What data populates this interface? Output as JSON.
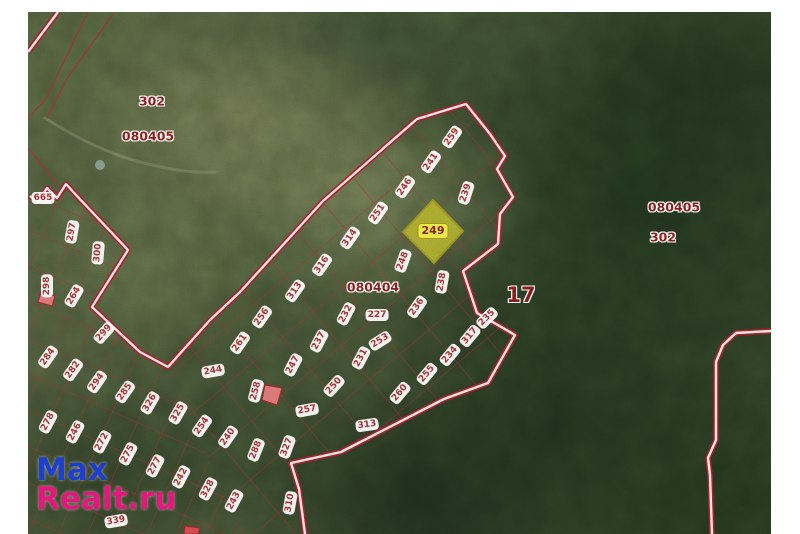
{
  "page": {
    "background": "#ffffff"
  },
  "map": {
    "type": "satellite-cadastral-map",
    "highlight_parcel": {
      "number": "249",
      "fill": "#d6d632",
      "border": "#b0a428"
    },
    "colors": {
      "boundary_red": "#c22330",
      "boundary_core": "#ffffff",
      "grid_red": "#c03434",
      "pill_background": "#ffffff",
      "pill_text": "#a83434",
      "quarter_text": "#8b1d1d",
      "pink_parcel_fill": "#f08888"
    },
    "watermark": {
      "line1": "Max",
      "line2": "Realt.ru",
      "color1": "#1e3fcb",
      "color2": "#e4187c"
    },
    "labels": [
      {
        "t": "302",
        "x": 152,
        "y": 101,
        "r": 0,
        "cls": "q"
      },
      {
        "t": "080405",
        "x": 148,
        "y": 136,
        "r": 0,
        "cls": "q"
      },
      {
        "t": "080405",
        "x": 674,
        "y": 207,
        "r": 0,
        "cls": "q"
      },
      {
        "t": "302",
        "x": 663,
        "y": 237,
        "r": 0,
        "cls": "q"
      },
      {
        "t": "080404",
        "x": 373,
        "y": 287,
        "r": 0,
        "cls": "q"
      },
      {
        "t": "17",
        "x": 521,
        "y": 295,
        "r": 0,
        "cls": "q17"
      },
      {
        "t": "249",
        "x": 433,
        "y": 231,
        "r": 0,
        "cls": "hl"
      },
      {
        "t": "259",
        "x": 452,
        "y": 137,
        "r": -55,
        "cls": "p"
      },
      {
        "t": "241",
        "x": 431,
        "y": 162,
        "r": -55,
        "cls": "p"
      },
      {
        "t": "246",
        "x": 405,
        "y": 187,
        "r": -55,
        "cls": "p"
      },
      {
        "t": "239",
        "x": 466,
        "y": 193,
        "r": -72,
        "cls": "p"
      },
      {
        "t": "251",
        "x": 378,
        "y": 213,
        "r": -55,
        "cls": "p"
      },
      {
        "t": "314",
        "x": 350,
        "y": 238,
        "r": -55,
        "cls": "p"
      },
      {
        "t": "316",
        "x": 322,
        "y": 265,
        "r": -55,
        "cls": "p"
      },
      {
        "t": "313",
        "x": 295,
        "y": 291,
        "r": -55,
        "cls": "p"
      },
      {
        "t": "256",
        "x": 262,
        "y": 317,
        "r": -55,
        "cls": "p"
      },
      {
        "t": "261",
        "x": 240,
        "y": 343,
        "r": -55,
        "cls": "p"
      },
      {
        "t": "248",
        "x": 403,
        "y": 261,
        "r": -70,
        "cls": "p"
      },
      {
        "t": "238",
        "x": 442,
        "y": 282,
        "r": -80,
        "cls": "p"
      },
      {
        "t": "236",
        "x": 417,
        "y": 307,
        "r": -55,
        "cls": "p"
      },
      {
        "t": "227",
        "x": 377,
        "y": 315,
        "r": 0,
        "cls": "p"
      },
      {
        "t": "232",
        "x": 346,
        "y": 314,
        "r": -62,
        "cls": "p"
      },
      {
        "t": "237",
        "x": 319,
        "y": 341,
        "r": -62,
        "cls": "p"
      },
      {
        "t": "253",
        "x": 380,
        "y": 341,
        "r": -32,
        "cls": "p"
      },
      {
        "t": "231",
        "x": 361,
        "y": 358,
        "r": -62,
        "cls": "p"
      },
      {
        "t": "247",
        "x": 293,
        "y": 365,
        "r": -62,
        "cls": "p"
      },
      {
        "t": "250",
        "x": 334,
        "y": 386,
        "r": -48,
        "cls": "p"
      },
      {
        "t": "260",
        "x": 400,
        "y": 393,
        "r": -50,
        "cls": "p"
      },
      {
        "t": "235",
        "x": 487,
        "y": 318,
        "r": -45,
        "cls": "p"
      },
      {
        "t": "317",
        "x": 470,
        "y": 336,
        "r": -50,
        "cls": "p"
      },
      {
        "t": "234",
        "x": 450,
        "y": 355,
        "r": -50,
        "cls": "p"
      },
      {
        "t": "255",
        "x": 427,
        "y": 374,
        "r": -50,
        "cls": "p"
      },
      {
        "t": "244",
        "x": 213,
        "y": 371,
        "r": -10,
        "cls": "p"
      },
      {
        "t": "258",
        "x": 256,
        "y": 391,
        "r": -75,
        "cls": "p"
      },
      {
        "t": "257",
        "x": 307,
        "y": 410,
        "r": -10,
        "cls": "p"
      },
      {
        "t": "313",
        "x": 367,
        "y": 425,
        "r": -8,
        "cls": "p"
      },
      {
        "t": "665",
        "x": 43,
        "y": 198,
        "r": 0,
        "cls": "p"
      },
      {
        "t": "297",
        "x": 72,
        "y": 232,
        "r": -80,
        "cls": "p"
      },
      {
        "t": "300",
        "x": 98,
        "y": 253,
        "r": -85,
        "cls": "p"
      },
      {
        "t": "298",
        "x": 47,
        "y": 286,
        "r": -90,
        "cls": "p"
      },
      {
        "t": "264",
        "x": 74,
        "y": 296,
        "r": -60,
        "cls": "p"
      },
      {
        "t": "299",
        "x": 104,
        "y": 333,
        "r": -48,
        "cls": "p"
      },
      {
        "t": "284",
        "x": 48,
        "y": 357,
        "r": -55,
        "cls": "p"
      },
      {
        "t": "282",
        "x": 73,
        "y": 370,
        "r": -55,
        "cls": "p"
      },
      {
        "t": "294",
        "x": 97,
        "y": 382,
        "r": -55,
        "cls": "p"
      },
      {
        "t": "285",
        "x": 125,
        "y": 392,
        "r": -55,
        "cls": "p"
      },
      {
        "t": "326",
        "x": 150,
        "y": 403,
        "r": -60,
        "cls": "p"
      },
      {
        "t": "325",
        "x": 178,
        "y": 413,
        "r": -60,
        "cls": "p"
      },
      {
        "t": "254",
        "x": 202,
        "y": 426,
        "r": -55,
        "cls": "p"
      },
      {
        "t": "240",
        "x": 228,
        "y": 437,
        "r": -55,
        "cls": "p"
      },
      {
        "t": "288",
        "x": 256,
        "y": 450,
        "r": -68,
        "cls": "p"
      },
      {
        "t": "278",
        "x": 48,
        "y": 422,
        "r": -62,
        "cls": "p"
      },
      {
        "t": "246",
        "x": 75,
        "y": 432,
        "r": -62,
        "cls": "p"
      },
      {
        "t": "272",
        "x": 102,
        "y": 442,
        "r": -62,
        "cls": "p"
      },
      {
        "t": "275",
        "x": 128,
        "y": 454,
        "r": -62,
        "cls": "p"
      },
      {
        "t": "277",
        "x": 155,
        "y": 466,
        "r": -62,
        "cls": "p"
      },
      {
        "t": "242",
        "x": 181,
        "y": 477,
        "r": -62,
        "cls": "p"
      },
      {
        "t": "328",
        "x": 208,
        "y": 489,
        "r": -62,
        "cls": "p"
      },
      {
        "t": "243",
        "x": 234,
        "y": 501,
        "r": -62,
        "cls": "p"
      },
      {
        "t": "339",
        "x": 116,
        "y": 521,
        "r": -10,
        "cls": "p"
      },
      {
        "t": "327",
        "x": 287,
        "y": 447,
        "r": -70,
        "cls": "p"
      },
      {
        "t": "310",
        "x": 290,
        "y": 503,
        "r": -80,
        "cls": "p"
      }
    ]
  }
}
